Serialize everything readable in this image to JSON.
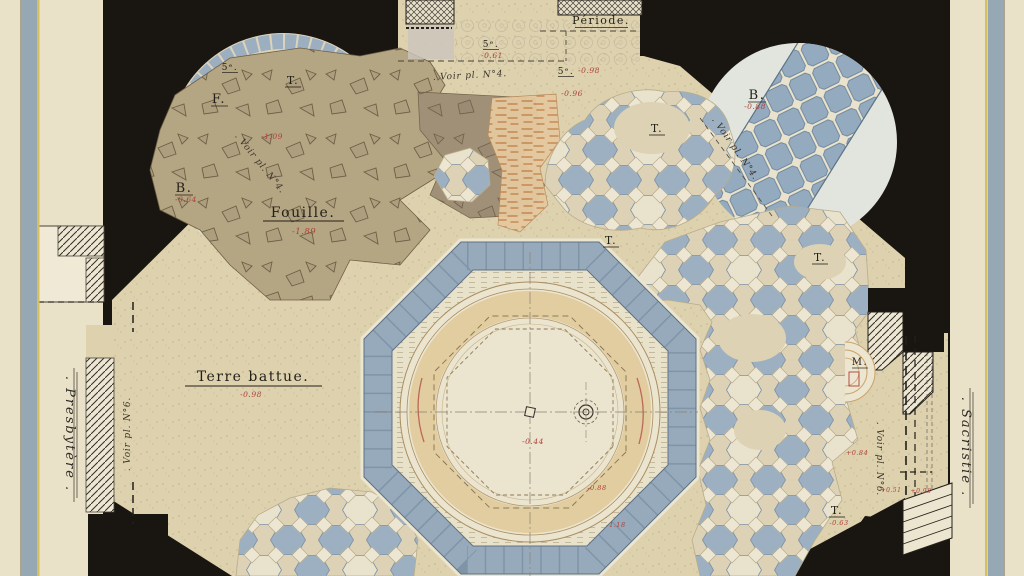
{
  "colors": {
    "paper": "#e9e1c8",
    "poche_black": "#191511",
    "floor_beige": "#ddd1ae",
    "tile_blue": "#9db0c2",
    "tile_cream": "#ece5d0",
    "step_band_blue": "#96aabc",
    "basin_tan": "#e2cda0",
    "fouille_brown": "#b4a583",
    "fouille_dark": "#a09078",
    "orange_sketch": "#d9a568",
    "red_ink": "#ae4137",
    "ink": "#23201a",
    "frame_band_blue": "#8ea3b1",
    "frame_band_yellow": "#d8bf5e"
  },
  "margins": {
    "left_label": ". Presbytère .",
    "right_label": ". Sacristie ."
  },
  "labels": {
    "periode": "Période.",
    "fouille": "Fouille.",
    "terre_battue": "Terre battue.",
    "f": "F.",
    "t": "T.",
    "b": "B.",
    "m": "M.",
    "five": "5ᵉ.",
    "voir4": ". Voir pl. N°4.",
    "voir6": ". Voir pl. N°6."
  },
  "levels": {
    "b_left": "-0.64",
    "apse_left": "-1.09",
    "fouille": "-1.89",
    "five_top": "-0.61",
    "five_right": "-0.98",
    "five_mid": "-0.96",
    "b_right": "-0.88",
    "terre": "-0.98",
    "basin": "-0.44",
    "basin_se1": "-0.88",
    "basin_se2": "-1.18",
    "niche": "+0.84",
    "t_bottom": "-0.63",
    "step1": "+0.51",
    "step2": "+0.98"
  }
}
